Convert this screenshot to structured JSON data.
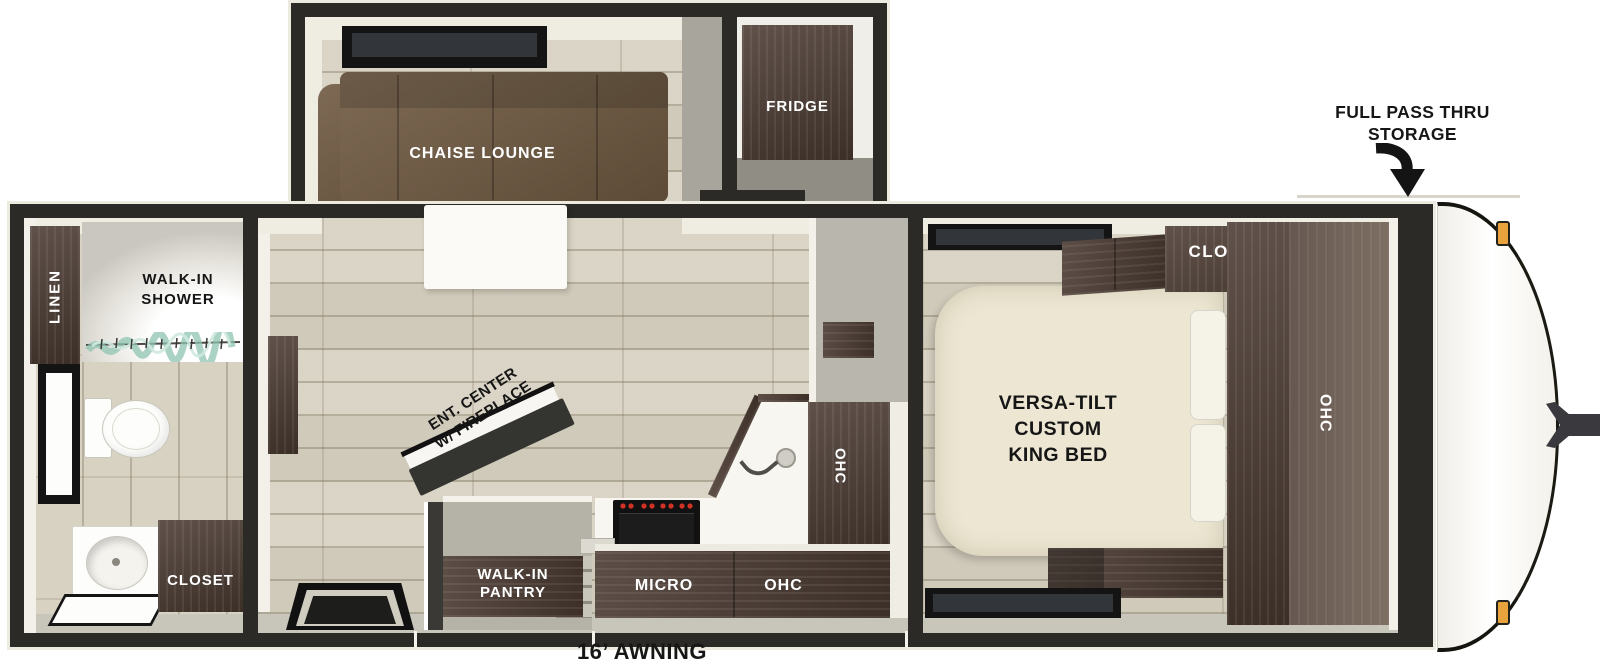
{
  "callouts": {
    "storage": "FULL PASS THRU\nSTORAGE",
    "awning": "16’ AWNING"
  },
  "living_area": {
    "chaise_lounge": "CHAISE LOUNGE",
    "fridge": "FRIDGE",
    "ent_center": "ENT. CENTER\nW/ FIREPLACE"
  },
  "kitchen": {
    "pantry": "WALK-IN\nPANTRY",
    "micro": "MICRO",
    "ohc_lower": "OHC",
    "ohc_upper": "OHC"
  },
  "bedroom": {
    "closet": "CLOSET",
    "bed": "VERSA-TILT\nCUSTOM\nKING BED",
    "ohc": "OHC"
  },
  "bathroom": {
    "shower": "WALK-IN\nSHOWER",
    "linen": "LINEN",
    "closet": "CLOSET"
  },
  "colors": {
    "wall": "#2b2a27",
    "floor": "#d8d2c2",
    "wood": "#4a3a31",
    "wood-light": "#6e6055",
    "sofa": "#6f5941",
    "bed": "#ece6d2",
    "counter": "#f7f6f1",
    "hallway": "#b9b6ad",
    "marker-light": "#e8a33d",
    "glass": "#9ccdbd"
  }
}
